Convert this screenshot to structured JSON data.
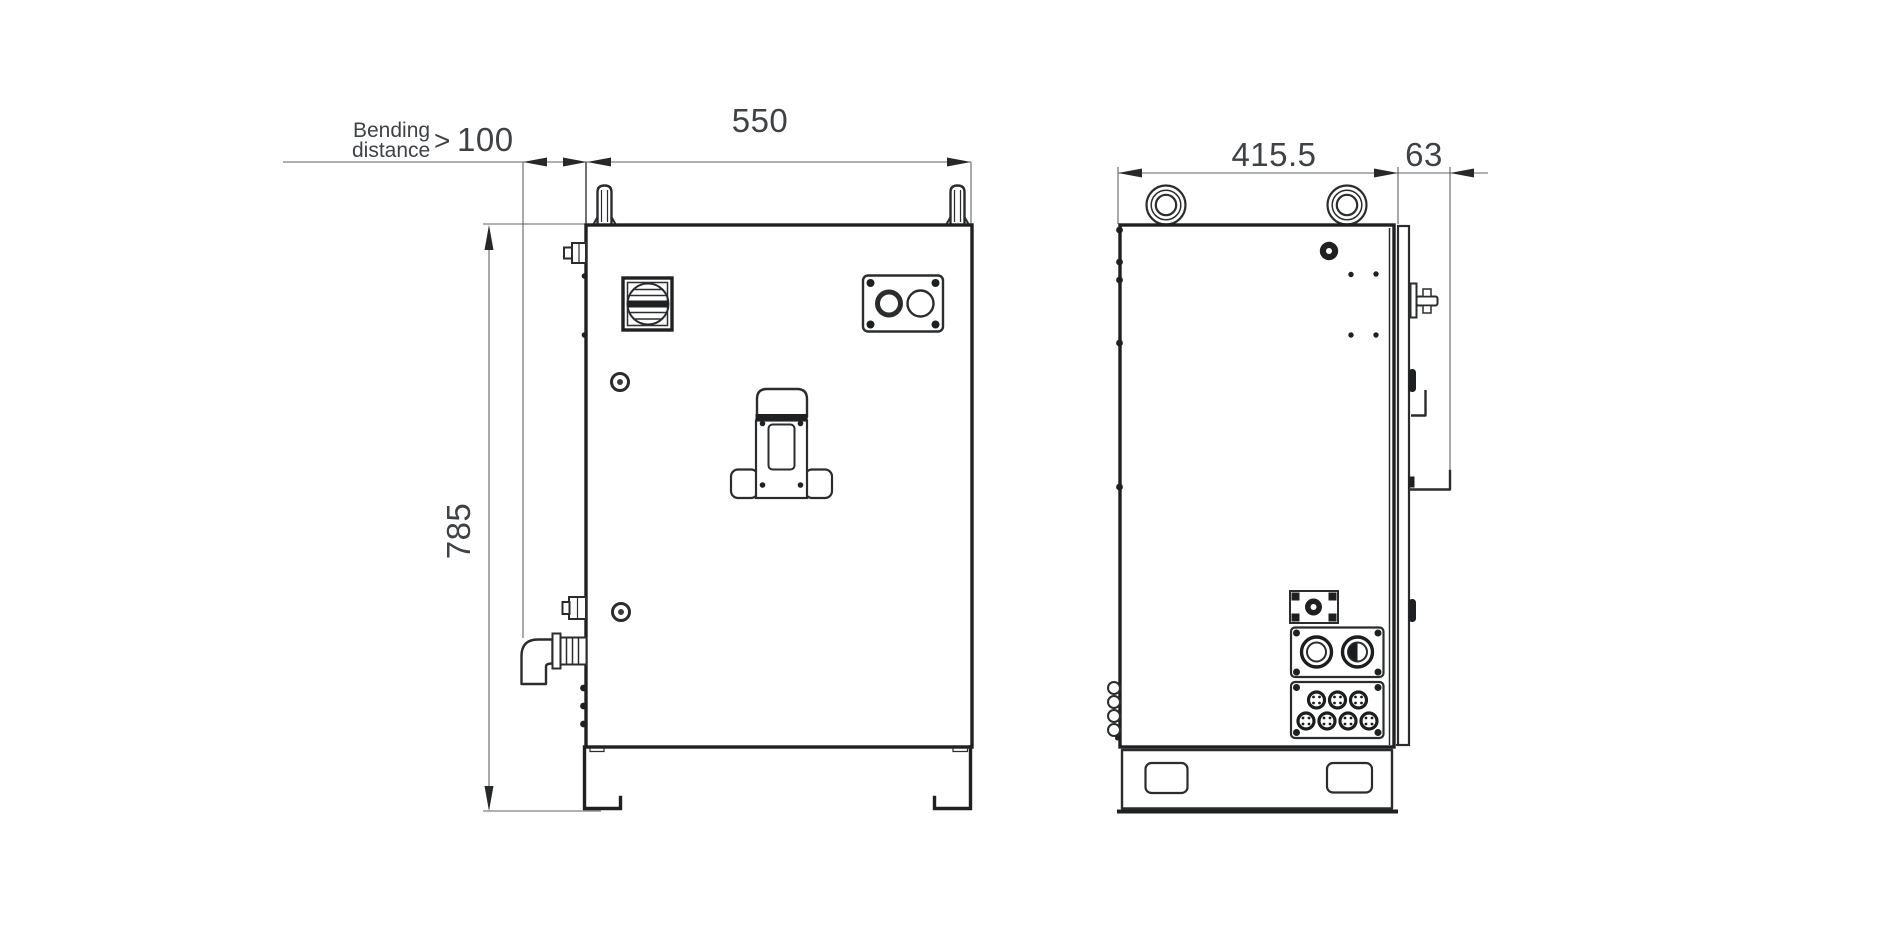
{
  "colors": {
    "background": "#ffffff",
    "outline": "#1e2021",
    "detail": "#2a2c2e",
    "dimension": "#606366",
    "dimension_text": "#3f4245",
    "arrow": "#26282a"
  },
  "labels": {
    "bending_note_line1": "Bending",
    "bending_note_line2": "distance",
    "bending_operator": ">",
    "bending_min_value": "100",
    "front_width_mm": "550",
    "front_height_mm": "785",
    "side_depth_mm": "415.5",
    "side_door_offset_mm": "63"
  }
}
